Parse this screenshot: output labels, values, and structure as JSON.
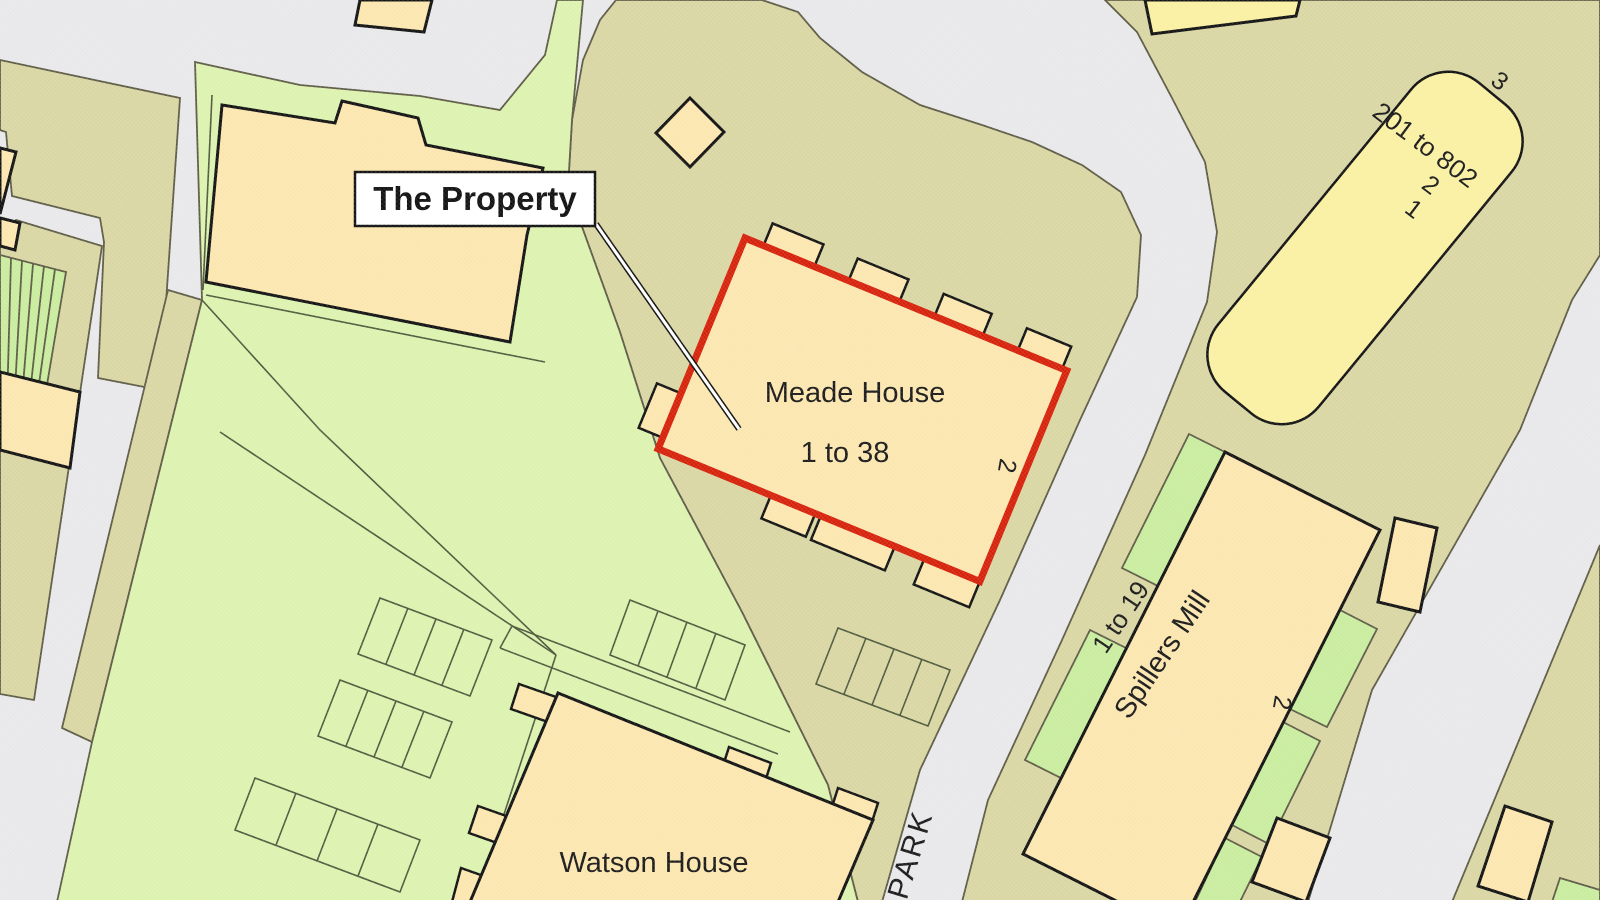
{
  "map": {
    "callout": {
      "label": "The Property"
    },
    "buildings": {
      "meade": {
        "name": "Meade House",
        "units": "1 to 38",
        "number": "2"
      },
      "watson": {
        "name": "Watson House"
      },
      "spillers": {
        "name": "Spillers Mill",
        "units": "1 to 19",
        "number": "2"
      },
      "tower": {
        "units": "201 to 802",
        "number_a": "2",
        "number_b": "1",
        "number_c": "3"
      }
    },
    "road": {
      "name": "PARK"
    }
  },
  "colors": {
    "road": "#E8E8EA",
    "tan": "#D9D6A3",
    "green": "#DCF2AF",
    "patch": "#C9EC9E",
    "building": "#FBE6AF",
    "tower_yellow": "#F9F0A2",
    "red": "#D6210B",
    "outline": "#121212",
    "text": "#1A1A1A"
  }
}
